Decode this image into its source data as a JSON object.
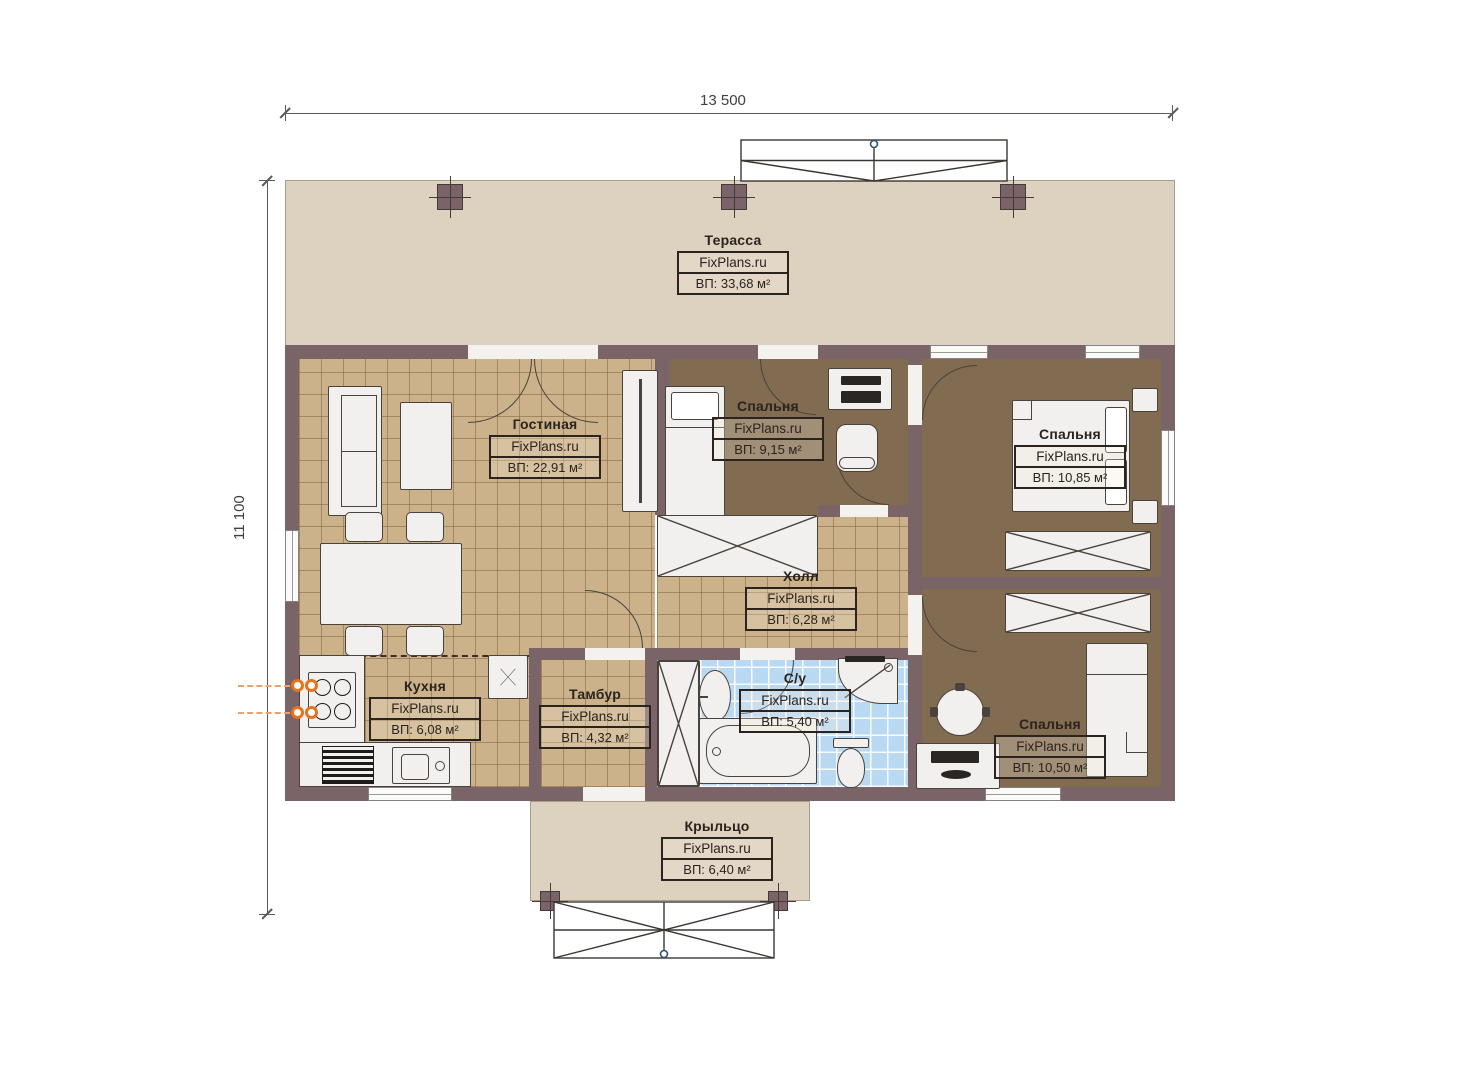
{
  "plan": {
    "watermark": "FixPlans.ru",
    "dimensions": {
      "width_label": "13 500",
      "height_label": "11 100"
    },
    "rooms": [
      {
        "id": "terrace",
        "name": "Терасса",
        "area": "ВП: 33,68 м²"
      },
      {
        "id": "living",
        "name": "Гостиная",
        "area": "ВП: 22,91 м²"
      },
      {
        "id": "bedroom1",
        "name": "Спальня",
        "area": "ВП: 9,15 м²"
      },
      {
        "id": "bedroom2",
        "name": "Спальня",
        "area": "ВП: 10,85 м²"
      },
      {
        "id": "hall",
        "name": "Холл",
        "area": "ВП: 6,28 м²"
      },
      {
        "id": "kitchen",
        "name": "Кухня",
        "area": "ВП: 6,08 м²"
      },
      {
        "id": "tambour",
        "name": "Тамбур",
        "area": "ВП: 4,32 м²"
      },
      {
        "id": "bathroom",
        "name": "С/у",
        "area": "ВП: 5,40 м²"
      },
      {
        "id": "bedroom3",
        "name": "Спальня",
        "area": "ВП: 10,50 м²"
      },
      {
        "id": "porch",
        "name": "Крыльцо",
        "area": "ВП: 6,40 м²"
      }
    ],
    "colors": {
      "wall": "#7b6467",
      "tile_tan": "#cbb28a",
      "floor_brown": "#826c51",
      "tile_blue": "#b9d9f3",
      "slab": "#ddd2c0",
      "utility_orange": "#e6731e",
      "ink": "#2b231d"
    }
  }
}
